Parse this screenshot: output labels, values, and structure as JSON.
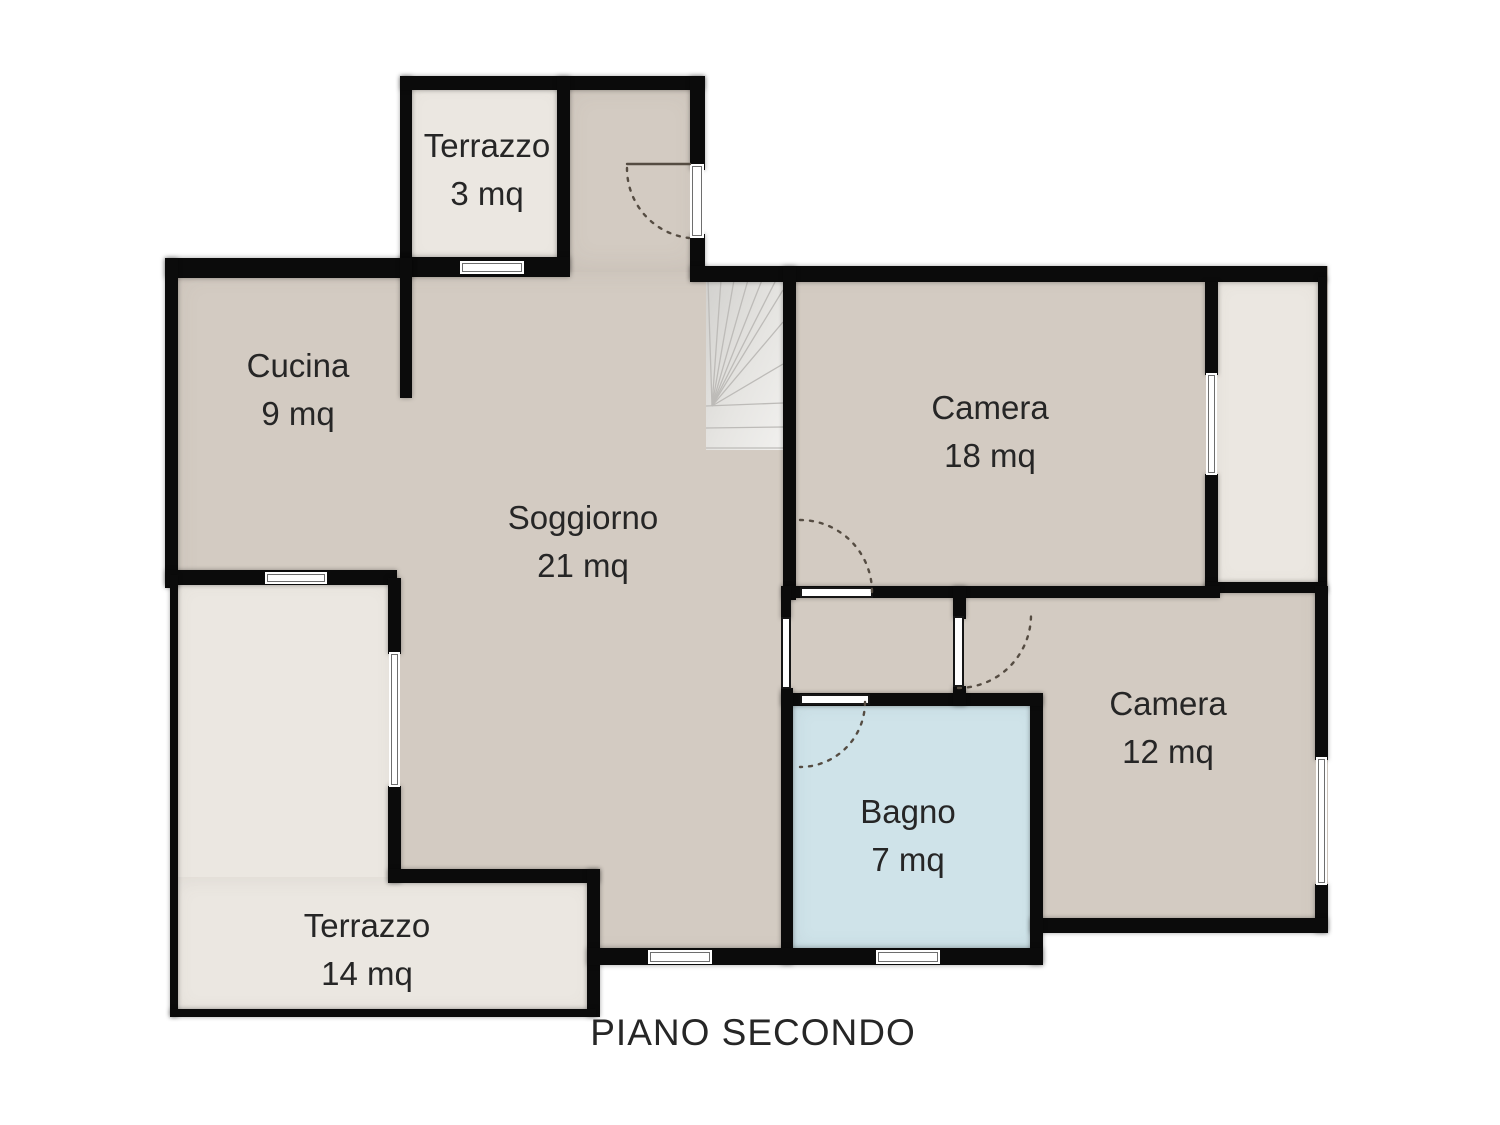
{
  "title": "PIANO SECONDO",
  "rooms": [
    {
      "id": "terrazzo-3",
      "name": "Terrazzo",
      "area": "3 mq"
    },
    {
      "id": "cucina",
      "name": "Cucina",
      "area": "9 mq"
    },
    {
      "id": "soggiorno",
      "name": "Soggiorno",
      "area": "21 mq"
    },
    {
      "id": "camera-18",
      "name": "Camera",
      "area": "18 mq"
    },
    {
      "id": "camera-12",
      "name": "Camera",
      "area": "12 mq"
    },
    {
      "id": "bagno",
      "name": "Bagno",
      "area": "7 mq"
    },
    {
      "id": "terrazzo-14",
      "name": "Terrazzo",
      "area": "14 mq"
    }
  ],
  "colors": {
    "floor": "#d3cbc2",
    "terrace": "#ebe7e1",
    "bath": "#cfe3e9",
    "wall": "#0b0b0b",
    "text": "#262626",
    "arc": "#554c42",
    "stair-a": "#d7d6d3",
    "stair-b": "#efeeec",
    "stair-line": "#bdbbb8"
  }
}
